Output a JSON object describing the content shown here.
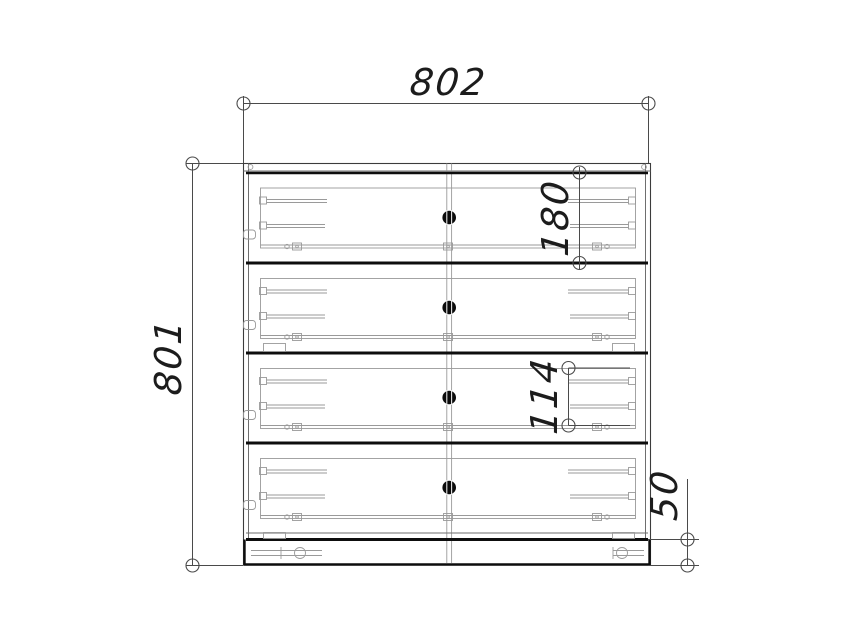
{
  "drawing": {
    "type": "furniture-front-elevation",
    "dimensions": {
      "overall_width": "802",
      "overall_height": "801",
      "drawer_front_height": "180",
      "drawer_box_height": "114",
      "plinth_height": "50"
    },
    "colors": {
      "background": "#ffffff",
      "outline_thick": "#0d0d0d",
      "outline_thin": "#6e6e6e",
      "detail_line": "#9a9a9a",
      "dimension_line": "#4a4a4a",
      "dimension_text": "#1c1c1c",
      "knob": "#0b0b0b"
    }
  }
}
